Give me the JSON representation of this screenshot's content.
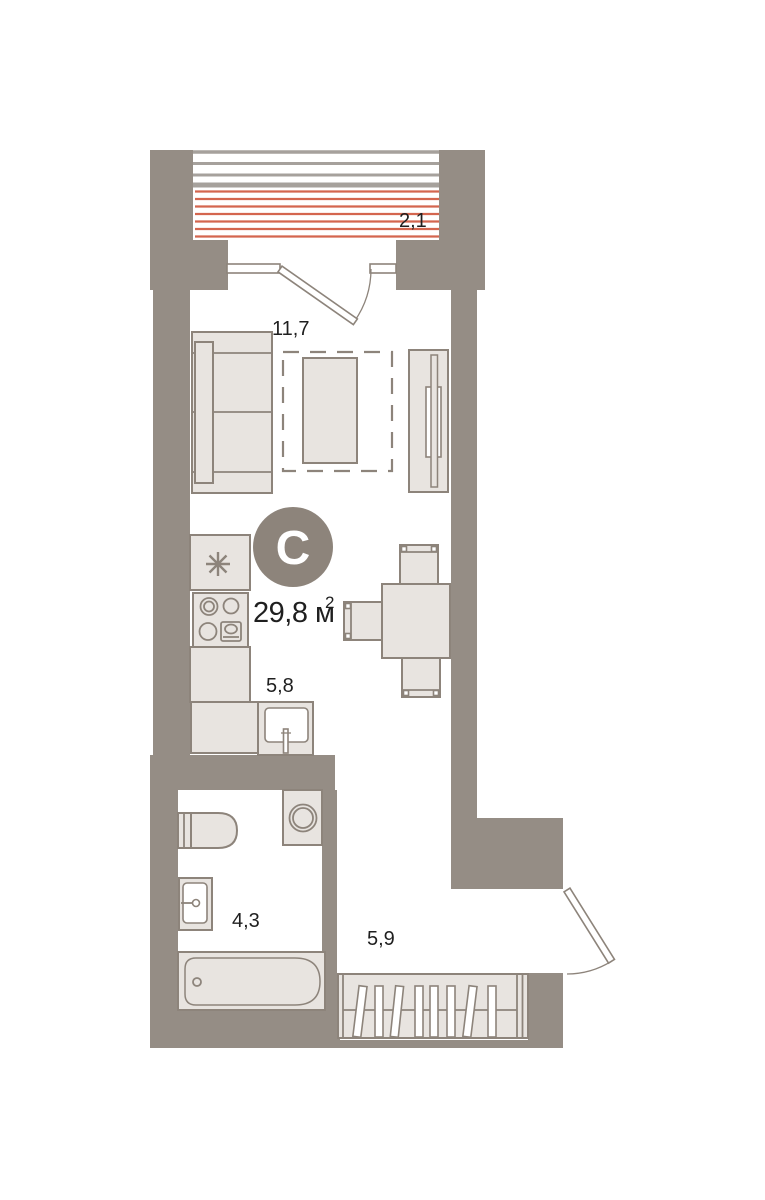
{
  "plan": {
    "logo_letter": "С",
    "total_area": "29,8 м",
    "total_area_sup": "2",
    "rooms": {
      "balcony": {
        "name": "balcony",
        "area": "2,1"
      },
      "living": {
        "name": "living-room",
        "area": "11,7"
      },
      "kitchen": {
        "name": "kitchen",
        "area": "5,8"
      },
      "bathroom": {
        "name": "bathroom",
        "area": "4,3"
      },
      "hallway": {
        "name": "hallway",
        "area": "5,9"
      }
    },
    "colors": {
      "background": "#ffffff",
      "wall": "#958d85",
      "furniture_fill": "#e8e4e0",
      "furniture_stroke": "#8d847b",
      "hatch_gray": "#a6a19c",
      "accent_red": "#d4664f",
      "text": "#1f1f1f",
      "logo_bg": "#8d847b",
      "logo_text": "#ffffff"
    }
  }
}
